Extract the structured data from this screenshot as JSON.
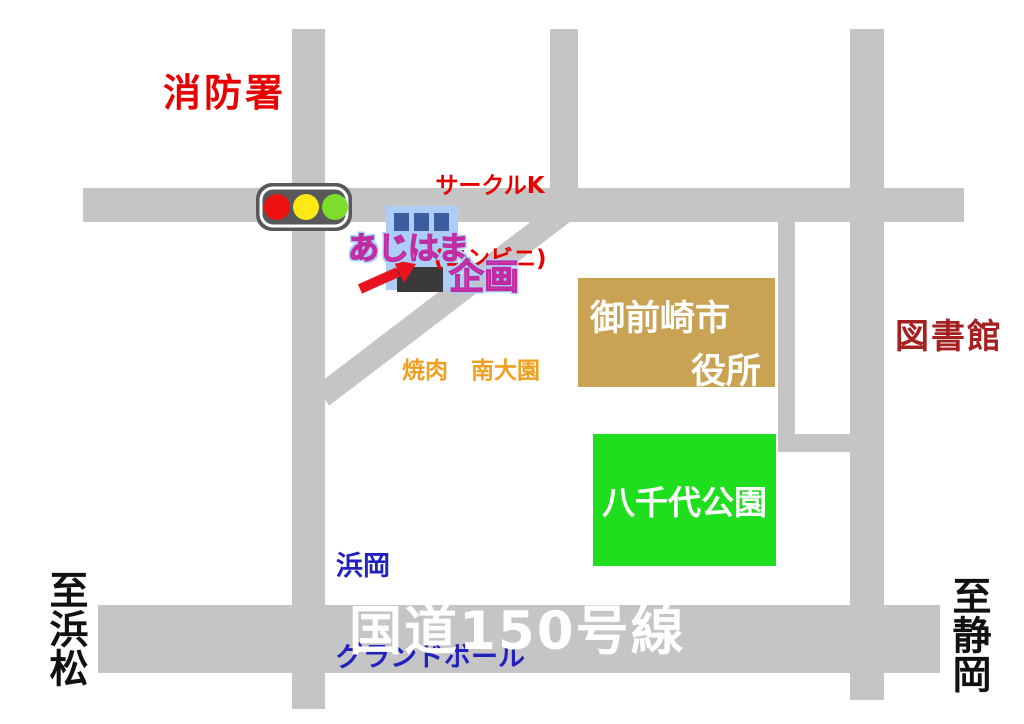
{
  "map": {
    "background": "#ffffff",
    "road_color": "#c5c5c5",
    "landmarks": {
      "fire_station": {
        "label": "消防署",
        "color": "#e60000"
      },
      "circle_k": {
        "line1": "サークルK",
        "line2": "(コンビニ)",
        "color": "#e60000"
      },
      "ajihama": {
        "line1": "あじはま",
        "line2": "企画",
        "fill": "#ff66d9",
        "outline": "#c02ba0",
        "glow": "#a6d2fa"
      },
      "yakiniku": {
        "label": "焼肉　南大園",
        "color": "#f0a020"
      },
      "city_hall": {
        "line1": "御前崎市",
        "line2": "役所",
        "bg": "#c9a353",
        "text_color": "#ffffff"
      },
      "library": {
        "label": "図書館",
        "color": "#a52020"
      },
      "park": {
        "label": "八千代公園",
        "bg": "#1ede1e",
        "text_color": "#ffffff"
      },
      "bowling": {
        "line1": "浜岡",
        "line2": "グランドボール",
        "color": "#2121bd"
      },
      "route_150": {
        "label": "国道150号線",
        "color": "#ffffff"
      },
      "to_hamamatsu": {
        "label": "至浜松",
        "color": "#111111"
      },
      "to_shizuoka": {
        "label": "至静岡",
        "color": "#111111"
      }
    },
    "traffic_light": {
      "body": "#58585a",
      "red": "#ee1111",
      "yellow": "#ffe813",
      "green": "#7edc2a"
    },
    "shop_icon": {
      "panel": "#aecdf6",
      "windows": "#3d5e9e",
      "base": "#3a3a3a",
      "arrow": "#e8131f"
    }
  }
}
